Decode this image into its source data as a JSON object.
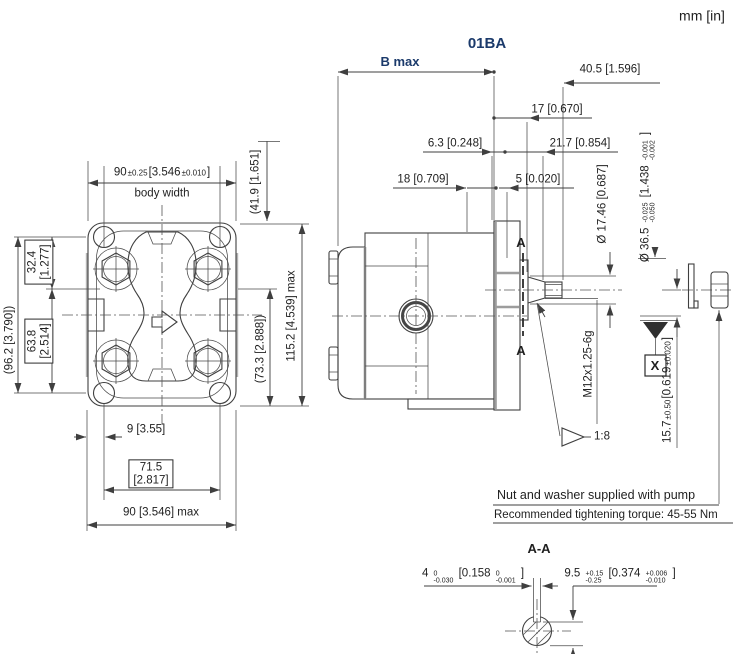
{
  "header": {
    "units": "mm [in]",
    "title": "01BA"
  },
  "colors": {
    "accent": "#1b3a6b",
    "line": "#3f3f3f"
  },
  "left_view": {
    "body_width_value": "90",
    "body_width_tol": "±0.25",
    "body_width_in": "[3.546",
    "body_width_tol_in": "±0.010",
    "body_width_close": "]",
    "body_width_label": "body width",
    "dim_41_9": "(41.9 [1.651]",
    "dim_115_2": "115.2 [4.539] max",
    "dim_73_3": "(73.3 [2.888])",
    "dim_96_2": "(96.2 [3.790])",
    "dim_32_4_mm": "32.4",
    "dim_32_4_in": "[1.277]",
    "dim_63_8_mm": "63.8",
    "dim_63_8_in": "[2.514]",
    "dim_9": "9 [3.55]",
    "dim_71_5_mm": "71.5",
    "dim_71_5_in": "[2.817]",
    "dim_90_max": "90 [3.546] max"
  },
  "side_view": {
    "dim_b_max": "B max",
    "dim_40_5": "40.5 [1.596]",
    "dim_17": "17 [0.670]",
    "dim_6_3": "6.3 [0.248]",
    "dim_21_7": "21.7 [0.854]",
    "dim_18": "18 [0.709]",
    "dim_5": "5 [0.020]",
    "dim_shaft_dia": "Ø 17.46 [0.687]",
    "dim_pilot_value": "Ø 36.5",
    "dim_pilot_tol_top": "-0.025",
    "dim_pilot_tol_bot": "-0.050",
    "dim_pilot_in": "[1.438",
    "dim_pilot_in_tol_top": "-0.001",
    "dim_pilot_in_tol_bot": "-0.002",
    "dim_pilot_close": "]",
    "thread_spec": "M12x1.25-6g",
    "dim_15_7_value": "15.7",
    "dim_15_7_tol": "±0.50",
    "dim_15_7_in": "[0.619",
    "dim_15_7_tol_in": "±0.020",
    "dim_15_7_close": "]",
    "taper_ratio": "1:8",
    "section_label": "A",
    "datum_label": "X"
  },
  "notes": {
    "note_supplied": "Nut and washer supplied with pump",
    "note_torque": "Recommended tightening torque: 45-55 Nm"
  },
  "section_aa": {
    "title": "A-A",
    "key_width_value": "4",
    "key_width_tol_top": "0",
    "key_width_tol_bot": "-0.030",
    "key_width_in": "[0.158",
    "key_width_in_tol_top": "0",
    "key_width_in_tol_bot": "-0.001",
    "key_width_close": "]",
    "key_height_value": "9.5",
    "key_height_tol_top": "+0.15",
    "key_height_tol_bot": "-0.25",
    "key_height_in": "[0.374",
    "key_height_in_tol_top": "+0.006",
    "key_height_in_tol_bot": "-0.010",
    "key_height_close": "]"
  }
}
